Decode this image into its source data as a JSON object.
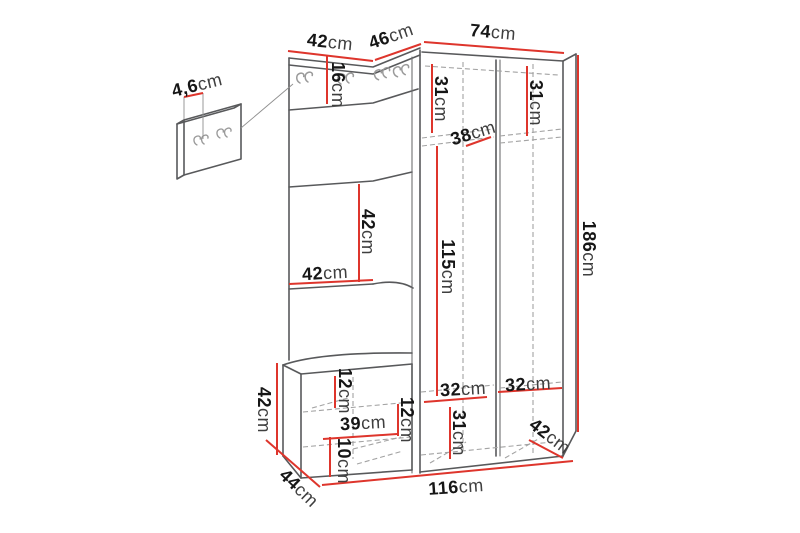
{
  "diagram": {
    "unit": "cm",
    "colors": {
      "dimension_line": "#de352c",
      "outline": "#58595b",
      "hidden_line": "#a3a3a3",
      "number_text": "#161616",
      "unit_text": "#3f3f3f",
      "background": "#ffffff"
    },
    "dims": {
      "top_left_width": {
        "value": "42",
        "unit": "cm"
      },
      "top_angled_width": {
        "value": "46",
        "unit": "cm"
      },
      "top_right_width": {
        "value": "74",
        "unit": "cm"
      },
      "hook_panel_thickness": {
        "value": "4,6",
        "unit": "cm"
      },
      "hook_rail_height": {
        "value": "16",
        "unit": "cm"
      },
      "upper_left_shelf_height": {
        "value": "31",
        "unit": "cm"
      },
      "upper_shelf_depth": {
        "value": "38",
        "unit": "cm"
      },
      "upper_right_shelf_height": {
        "value": "31",
        "unit": "cm"
      },
      "mirror_height": {
        "value": "42",
        "unit": "cm"
      },
      "left_panel_width": {
        "value": "42",
        "unit": "cm"
      },
      "middle_inner_height": {
        "value": "115",
        "unit": "cm"
      },
      "total_height": {
        "value": "186",
        "unit": "cm"
      },
      "bench_height": {
        "value": "42",
        "unit": "cm"
      },
      "bench_top_gap": {
        "value": "12",
        "unit": "cm"
      },
      "bench_shelf_width": {
        "value": "39",
        "unit": "cm"
      },
      "bench_side_gap": {
        "value": "12",
        "unit": "cm"
      },
      "bench_bottom_gap": {
        "value": "10",
        "unit": "cm"
      },
      "lower_left_shelf_width": {
        "value": "32",
        "unit": "cm"
      },
      "lower_shelf_height": {
        "value": "31",
        "unit": "cm"
      },
      "lower_right_shelf_width": {
        "value": "32",
        "unit": "cm"
      },
      "lower_shelf_depth": {
        "value": "42",
        "unit": "cm"
      },
      "bench_depth": {
        "value": "44",
        "unit": "cm"
      },
      "base_width": {
        "value": "116",
        "unit": "cm"
      }
    }
  }
}
